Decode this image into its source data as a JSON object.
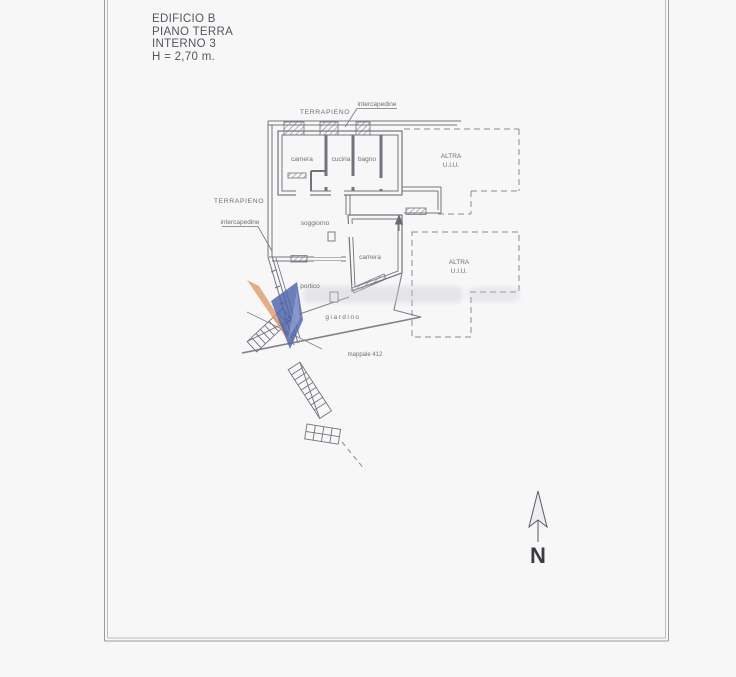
{
  "title_block": {
    "building": "EDIFICIO  B",
    "floor": "PIANO TERRA",
    "unit": "INTERNO 3",
    "height": "H = 2,70 m."
  },
  "plan": {
    "terrapieno_top": "TERRAPIENO",
    "intercapedine_top": "intercapedine",
    "terrapieno_left": "TERRAPIENO",
    "intercapedine_left": "intercapedine",
    "rooms": {
      "camera1": "camera",
      "cucina": "cucina",
      "bagno": "bagno",
      "soggiorno": "soggiorno",
      "camera2": "camera",
      "portico": "portico",
      "giardino": "giardino"
    },
    "adjacent_units": {
      "altra1_line1": "ALTRA",
      "altra1_line2": "U.I.U.",
      "altra2_line1": "ALTRA",
      "altra2_line2": "U.I.U."
    },
    "parcel": "mappale 412"
  },
  "compass": {
    "north": "N"
  },
  "colors": {
    "line_gray": "#73737d",
    "watermark_blue": "#4c63a9",
    "watermark_light_blue": "#93a3d2",
    "watermark_orange": "#dd9a6a"
  }
}
